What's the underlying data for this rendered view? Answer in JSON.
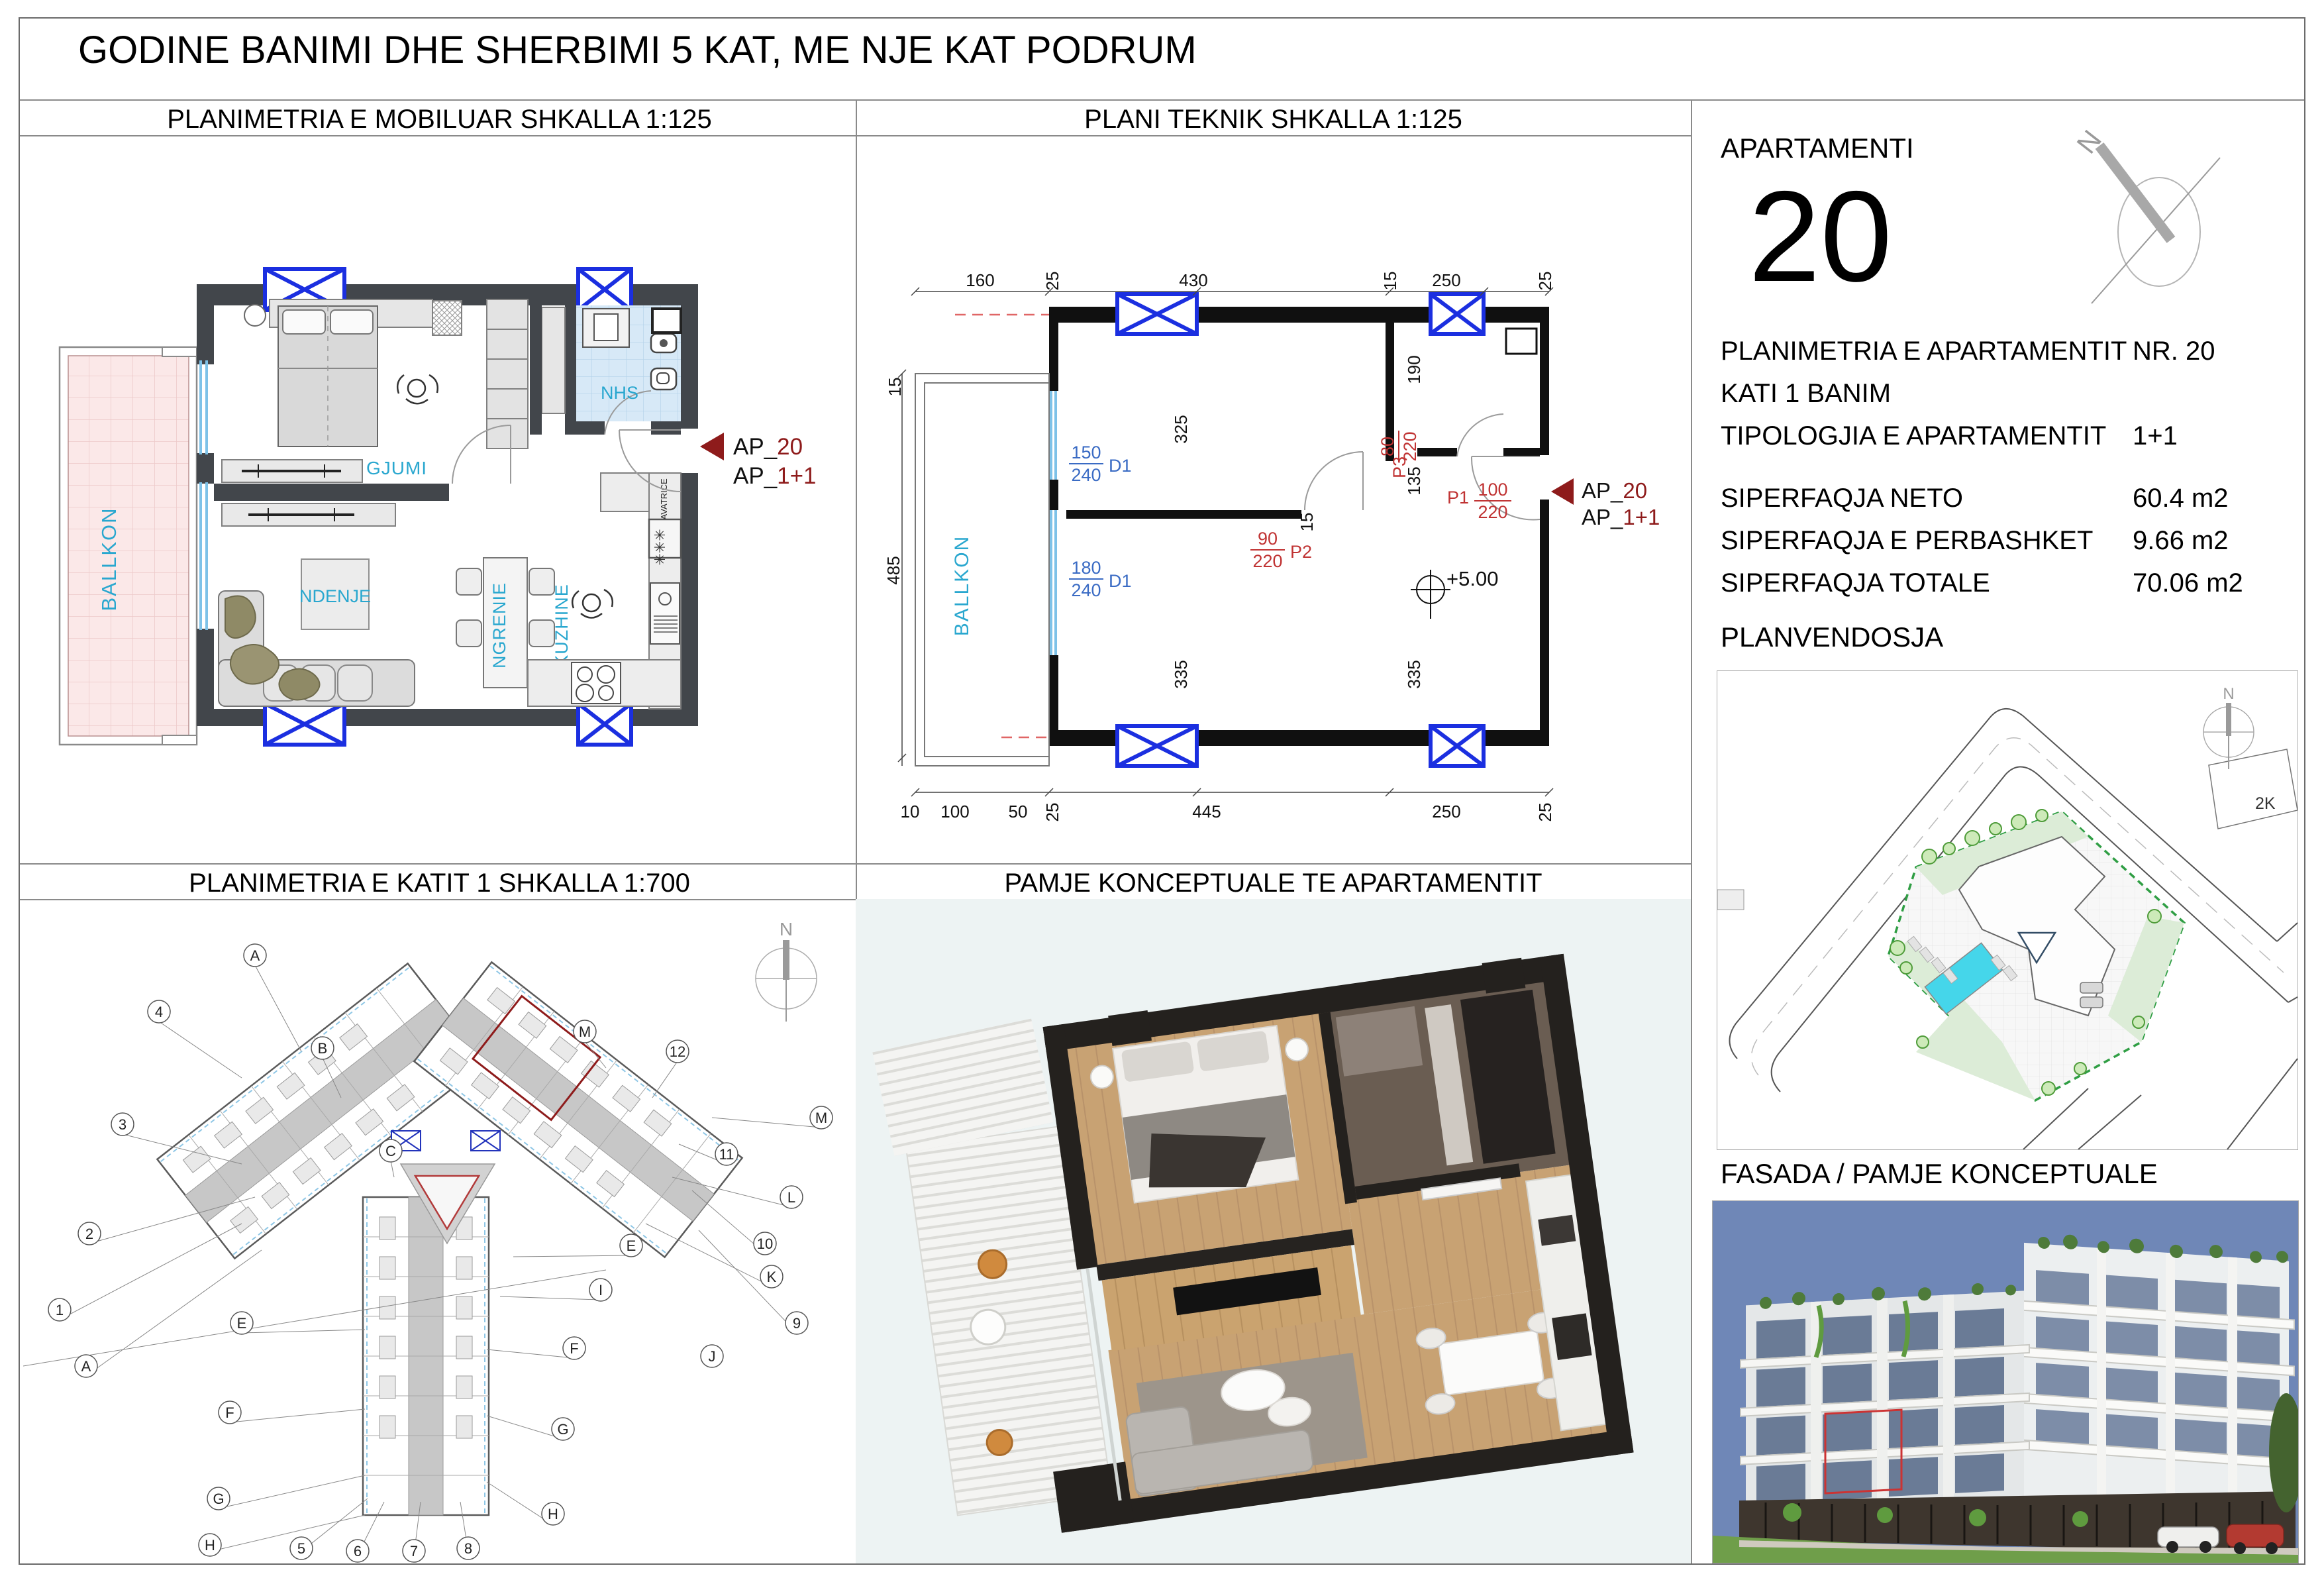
{
  "page": {
    "title": "GODINE BANIMI DHE SHERBIMI 5 KAT, ME NJE KAT PODRUM"
  },
  "panels": {
    "mobiluar_title": "PLANIMETRIA E MOBILUAR  SHKALLA 1:125",
    "teknik_title": "PLANI TEKNIK   SHKALLA 1:125",
    "katit_title": "PLANIMETRIA E KATIT 1    SHKALLA 1:700",
    "pamje_title": "PAMJE KONCEPTUALE TE APARTAMENTIT"
  },
  "sidebar": {
    "apartamenti_label": "APARTAMENTI",
    "apartment_number": "20",
    "rows": [
      {
        "label": "PLANIMETRIA E APARTAMENTIT",
        "value": "NR. 20"
      },
      {
        "label": "KATI 1 BANIM",
        "value": ""
      },
      {
        "label": "TIPOLOGJIA E APARTAMENTIT",
        "value": "1+1"
      },
      {
        "label": "SIPERFAQJA NETO",
        "value": "60.4 m2"
      },
      {
        "label": "SIPERFAQJA E PERBASHKET",
        "value": "9.66 m2"
      },
      {
        "label": "SIPERFAQJA TOTALE",
        "value": "70.06 m2"
      }
    ],
    "planvendosja_title": "PLANVENDOSJA",
    "fasada_title": "FASADA / PAMJE KONCEPTUALE",
    "north_letter": "N",
    "site_parcel_label": "2K"
  },
  "rooms": {
    "ballkon": "BALLKON",
    "bedroom": "DHOME GJUMI",
    "living": "NDENJE",
    "dining": "NGRENIE",
    "kitchen": "KUZHINE",
    "bath": "NHS",
    "washer": "LAVATRICE"
  },
  "marker": {
    "prefix": "AP_",
    "num": "20",
    "typ": "1+1"
  },
  "teknik": {
    "level": "+5.00",
    "win1_num": "150",
    "win1_den": "240",
    "win1_tag": "D1",
    "win2_num": "180",
    "win2_den": "240",
    "win2_tag": "D1",
    "door1_tag": "P1",
    "door1_num": "100",
    "door1_den": "220",
    "door2_tag": "P2",
    "door2_num": "90",
    "door2_den": "220",
    "door3_tag": "P3",
    "door3_num": "80",
    "door3_den": "220",
    "dims": {
      "d160": "160",
      "d25a": "25",
      "d430": "430",
      "d15a": "15",
      "d250a": "250",
      "d25b": "25",
      "d15b": "15",
      "d485": "485",
      "d10": "10",
      "d100": "100",
      "d50": "50",
      "d25c": "25",
      "d445": "445",
      "d250b": "250",
      "d25d": "25",
      "d325": "325",
      "d190": "190",
      "d135": "135",
      "d335a": "335",
      "d335b": "335",
      "d15c": "15"
    }
  },
  "katit": {
    "north": "N",
    "bubbles": [
      "A",
      "4",
      "B",
      "3",
      "C",
      "2",
      "1",
      "A",
      "E",
      "F",
      "G",
      "H",
      "5",
      "6",
      "7",
      "8",
      "H",
      "G",
      "F",
      "I",
      "E",
      "J",
      "K",
      "L",
      "M",
      "12",
      "11",
      "10",
      "9",
      "M"
    ]
  },
  "colors": {
    "wall_dark": "#42464b",
    "column_blue": "#1b2fe0",
    "label_cyan": "#29a7cf",
    "marker_red": "#8e1b1b",
    "dim_red": "#c03333",
    "dim_blue": "#3a6bc4",
    "balcony_pink": "#fbe8e8",
    "bath_blue": "#d7e9f7",
    "sky": "#6f87b7",
    "boundary_green": "#2f9e44",
    "pool_cyan": "#45d6ea"
  }
}
